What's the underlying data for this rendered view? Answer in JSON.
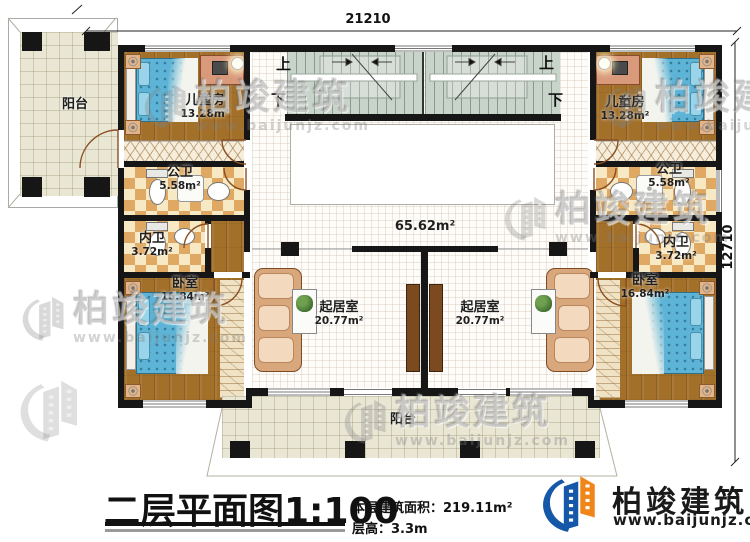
{
  "dimensions": {
    "width": "21210",
    "height": "12710"
  },
  "stairs": {
    "up": "上",
    "down": "下"
  },
  "hall": {
    "area": "65.62m²"
  },
  "rooms": {
    "balcony_left": {
      "name": "阳台"
    },
    "balcony_bottom": {
      "name": "阳台"
    },
    "child_left": {
      "name": "儿童房",
      "area": "13.28m²"
    },
    "child_right": {
      "name": "儿童房",
      "area": "13.28m²"
    },
    "public_bath_left": {
      "name": "公卫",
      "area": "5.58m²"
    },
    "public_bath_right": {
      "name": "公卫",
      "area": "5.58m²"
    },
    "inner_bath_left": {
      "name": "内卫",
      "area": "3.72m²"
    },
    "inner_bath_right": {
      "name": "内卫",
      "area": "3.72m²"
    },
    "bedroom_left": {
      "name": "卧室",
      "area": "16.84m²"
    },
    "bedroom_right": {
      "name": "卧室",
      "area": "16.84m²"
    },
    "living_left": {
      "name": "起居室",
      "area": "20.77m²"
    },
    "living_right": {
      "name": "起居室",
      "area": "20.77m²"
    }
  },
  "footer": {
    "title": "二层平面图1:100",
    "area_label": "本层建筑面积：",
    "area_value": "219.11m²",
    "floor_height_label": "层高：",
    "floor_height_value": "3.3m"
  },
  "brand": {
    "name": "柏竣建筑",
    "url": "www.baijunjz.com"
  },
  "watermark": {
    "name": "柏竣建筑",
    "url": "www.baijunjz.com"
  }
}
